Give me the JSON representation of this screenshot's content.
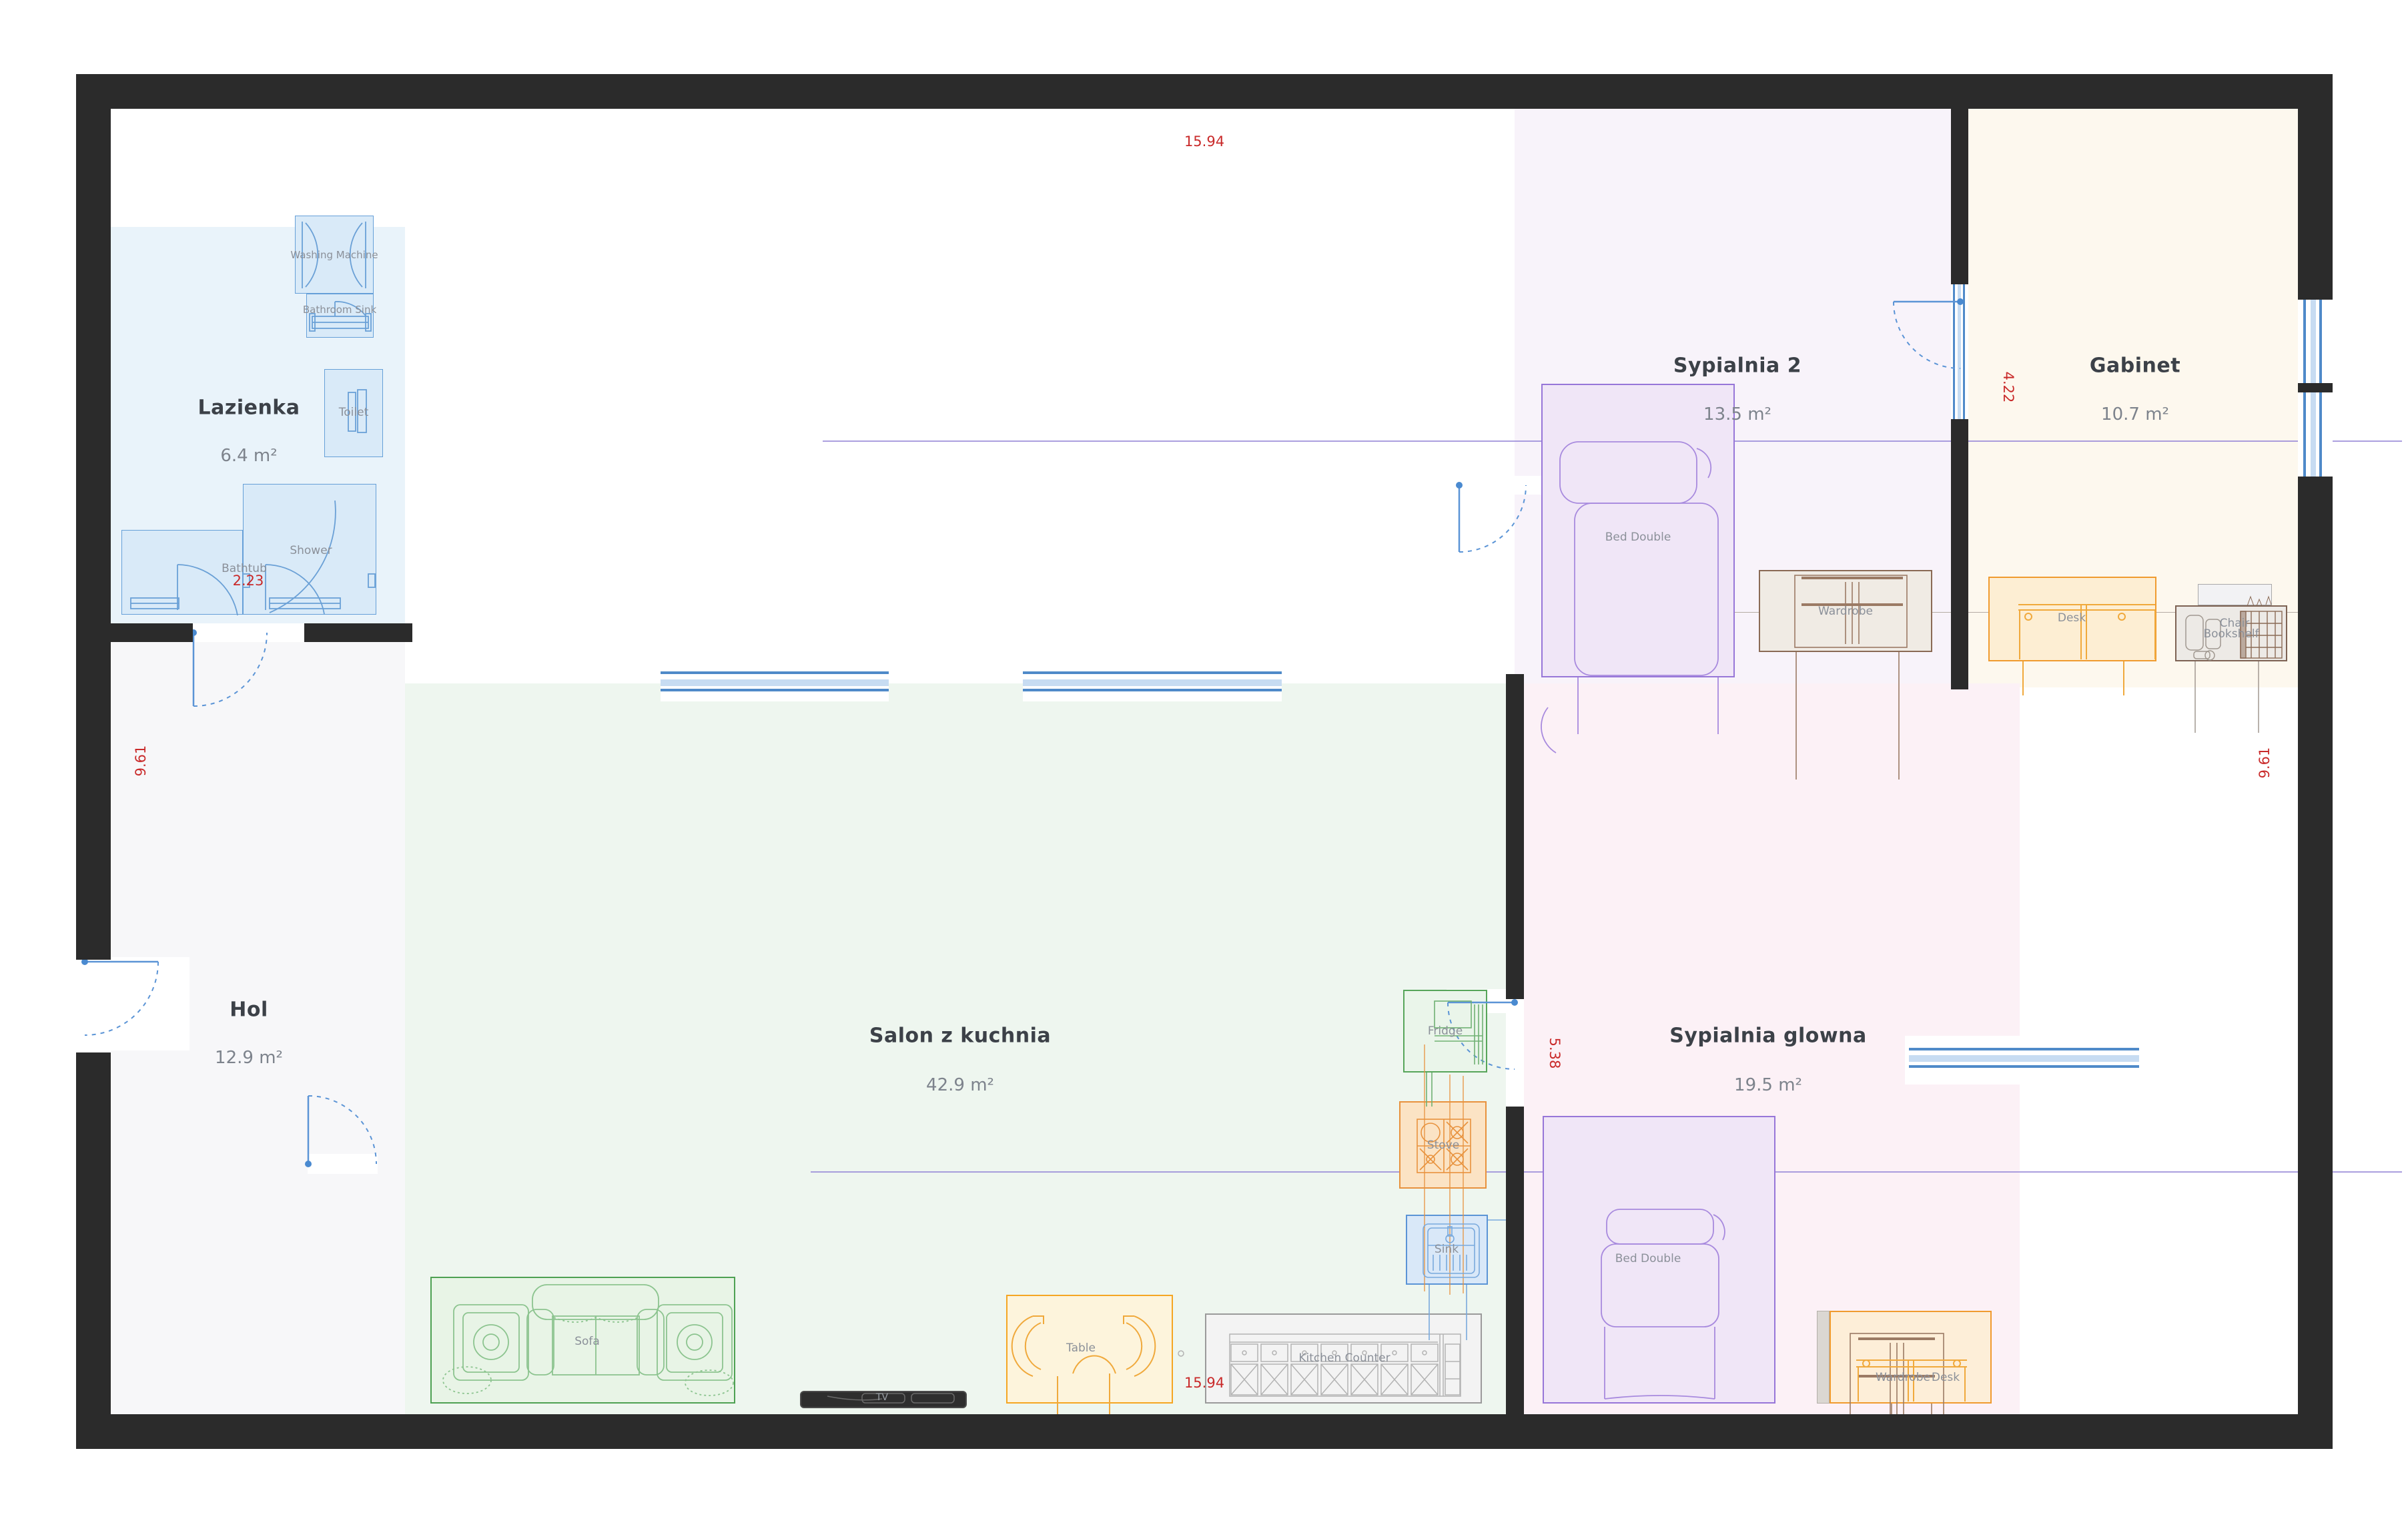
{
  "rooms": {
    "lazienka": {
      "name": "Lazienka",
      "area": "6.4 m²"
    },
    "hol": {
      "name": "Hol",
      "area": "12.9 m²"
    },
    "salon": {
      "name": "Salon z kuchnia",
      "area": "42.9 m²"
    },
    "sypialnia2": {
      "name": "Sypialnia 2",
      "area": "13.5 m²"
    },
    "gabinet": {
      "name": "Gabinet",
      "area": "10.7 m²"
    },
    "sypialnia_glowna": {
      "name": "Sypialnia glowna",
      "area": "19.5 m²"
    }
  },
  "labels": {
    "washing_machine": "Washing Machine",
    "bathroom_sink": "Bathroom Sink",
    "toilet": "Toilet",
    "bathtub": "Bathtub",
    "shower": "Shower",
    "sofa": "Sofa",
    "tv": "TV",
    "table": "Table",
    "kitchen_counter": "Kitchen Counter",
    "fridge": "Fridge",
    "stove": "Stove",
    "sink": "Sink",
    "bed_double": "Bed Double",
    "wardrobe": "Wardrobe",
    "desk": "Desk",
    "chair": "Chair",
    "bookshelf": "Bookshelf"
  },
  "dimensions": {
    "width_top": "15.94",
    "width_bottom": "15.94",
    "height_left": "9.61",
    "height_right": "9.61",
    "lazienka_span": "2.23",
    "gabinet_span": "4.22",
    "salon_span": "5.38"
  },
  "colors": {
    "wall": "#2b2b2b",
    "door": "#5b94d6",
    "dimension_text": "#c92a2a",
    "lazienka_bg": "#e9f3fa",
    "hol_bg": "#f7f7f9",
    "salon_bg": "#eef6ef",
    "sypialnia2_bg": "#f8f3fa",
    "gabinet_bg": "#fdf8ee",
    "sypialnia_glowna_bg": "#fcf1f6"
  }
}
